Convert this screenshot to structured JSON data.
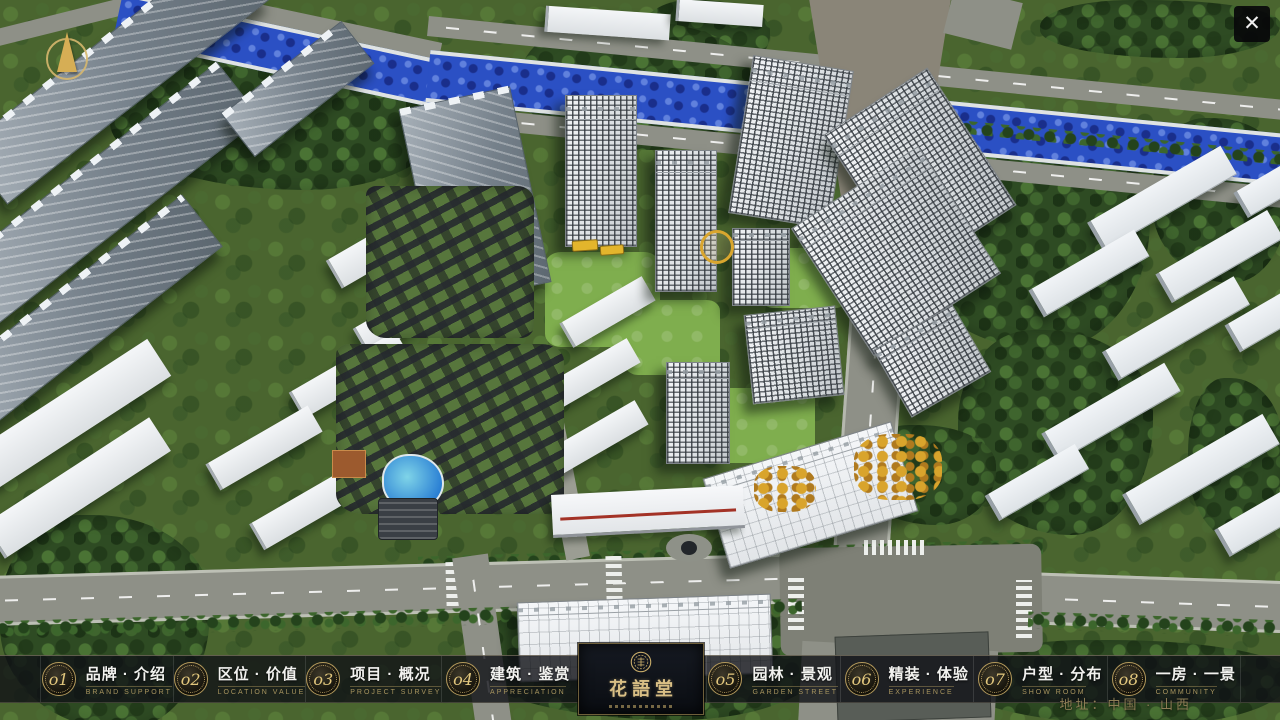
{
  "navbar": {
    "items": [
      {
        "num": "o1",
        "zh": "品牌 · 介绍",
        "en": "BRAND SUPPORT"
      },
      {
        "num": "o2",
        "zh": "区位 · 价值",
        "en": "LOCATION VALUE"
      },
      {
        "num": "o3",
        "zh": "项目 · 概况",
        "en": "PROJECT SURVEY"
      },
      {
        "num": "o4",
        "zh": "建筑 · 鉴赏",
        "en": "APPRECIATION"
      },
      {
        "num": "o5",
        "zh": "园林 · 景观",
        "en": "GARDEN STREET"
      },
      {
        "num": "o6",
        "zh": "精装 · 体验",
        "en": "EXPERIENCE"
      },
      {
        "num": "o7",
        "zh": "户型 · 分布",
        "en": "SHOW ROOM"
      },
      {
        "num": "o8",
        "zh": "一房 · 一景",
        "en": "COMMUNITY"
      }
    ],
    "logo": {
      "title": "花語堂"
    },
    "address": "地址：中国 · 山西"
  },
  "icons": {
    "close_glyph": "✕",
    "compass": "north-arrow",
    "logo_seal": "circular-seal"
  },
  "colors": {
    "accent_gold": "#C9AD6A",
    "navbar_bg": "#14161A",
    "logo_panel_bg": "#0D1117",
    "river_blue": "#2B50C4",
    "road_gray": "#8E9087",
    "canopy_green": "#2E4B23"
  }
}
